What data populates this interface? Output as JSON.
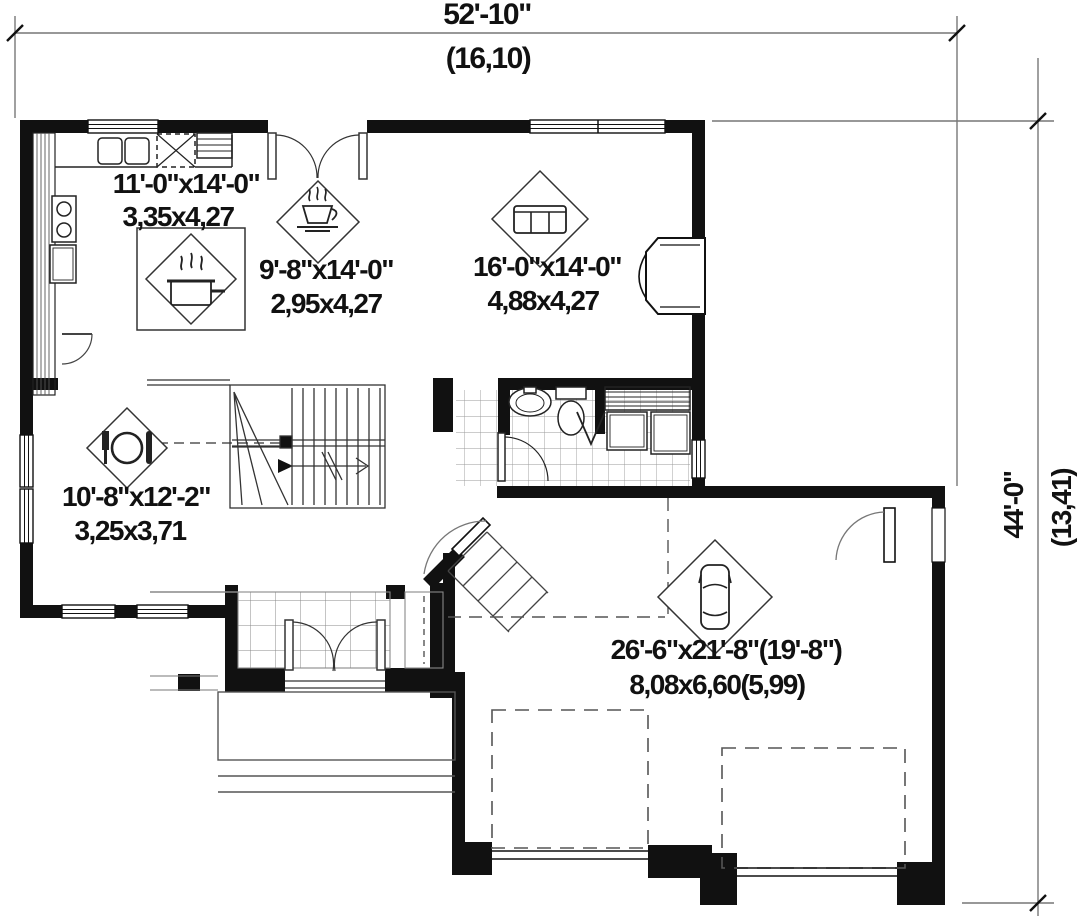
{
  "meta": {
    "drawing_type": "first-floor-plan"
  },
  "dimensions": {
    "top": {
      "imperial": "52'-10\"",
      "metric": "(16,10)"
    },
    "right": {
      "imperial": "44'-0\"",
      "metric": "(13,41)"
    }
  },
  "rooms": {
    "kitchen": {
      "imperial": "11'-0\"x14'-0\"",
      "metric": "3,35x4,27",
      "icon": "cooking-pot-icon"
    },
    "dinette": {
      "imperial": "9'-8\"x14'-0\"",
      "metric": "2,95x4,27",
      "icon": "coffee-cup-icon"
    },
    "living": {
      "imperial": "16'-0\"x14'-0\"",
      "metric": "4,88x4,27",
      "icon": "sofa-icon"
    },
    "dining": {
      "imperial": "10'-8\"x12'-2\"",
      "metric": "3,25x3,71",
      "icon": "plate-cutlery-icon"
    },
    "garage": {
      "imperial": "26'-6\"x21'-8\"(19'-8\")",
      "metric": "8,08x6,60(5,99)",
      "icon": "car-icon"
    }
  },
  "colors": {
    "ink": "#111111",
    "construction_line": "#777777",
    "paper": "#ffffff"
  }
}
